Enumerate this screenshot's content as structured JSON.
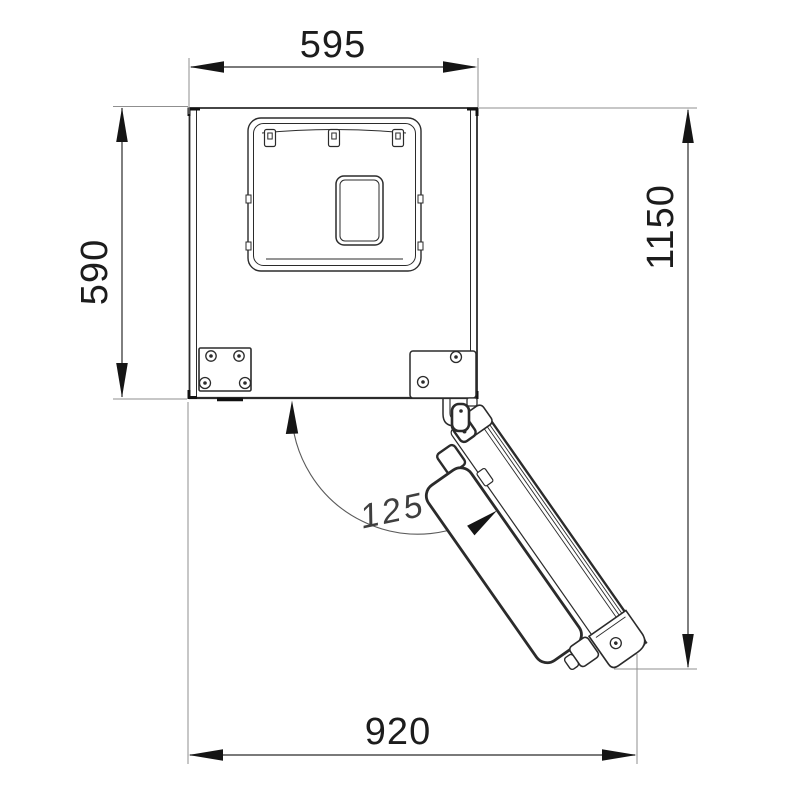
{
  "drawing": {
    "dimension_top_width": "595",
    "dimension_left_depth": "590",
    "dimension_right_total_depth": "1150",
    "dimension_bottom_total_width": "920",
    "door_opening_angle": "125°"
  },
  "colors": {
    "line": "#2b2b2b",
    "extension_line": "#8f8f8f",
    "arrow": "#151515",
    "dimension_text": "#1c1c1c",
    "angle_text": "#3f3f3f",
    "background": "#ffffff"
  }
}
